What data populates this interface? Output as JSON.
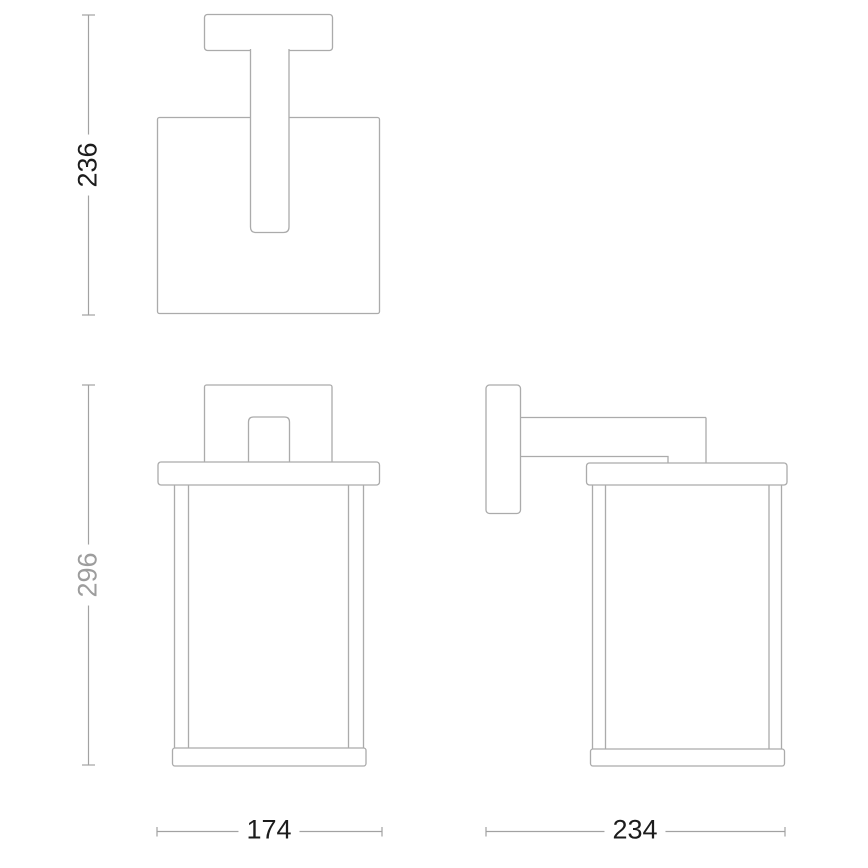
{
  "colors": {
    "background": "#ffffff",
    "outline": "#ababab",
    "dimension_line": "#a2a2a2",
    "dimension_text_primary": "#1c1c1c",
    "dimension_text_secondary": "#9d9d9d"
  },
  "dimensions": {
    "top_height": {
      "value": "236",
      "orientation": "vertical"
    },
    "front_height": {
      "value": "296",
      "orientation": "vertical"
    },
    "front_width": {
      "value": "174",
      "orientation": "horizontal"
    },
    "side_depth": {
      "value": "234",
      "orientation": "horizontal"
    }
  }
}
